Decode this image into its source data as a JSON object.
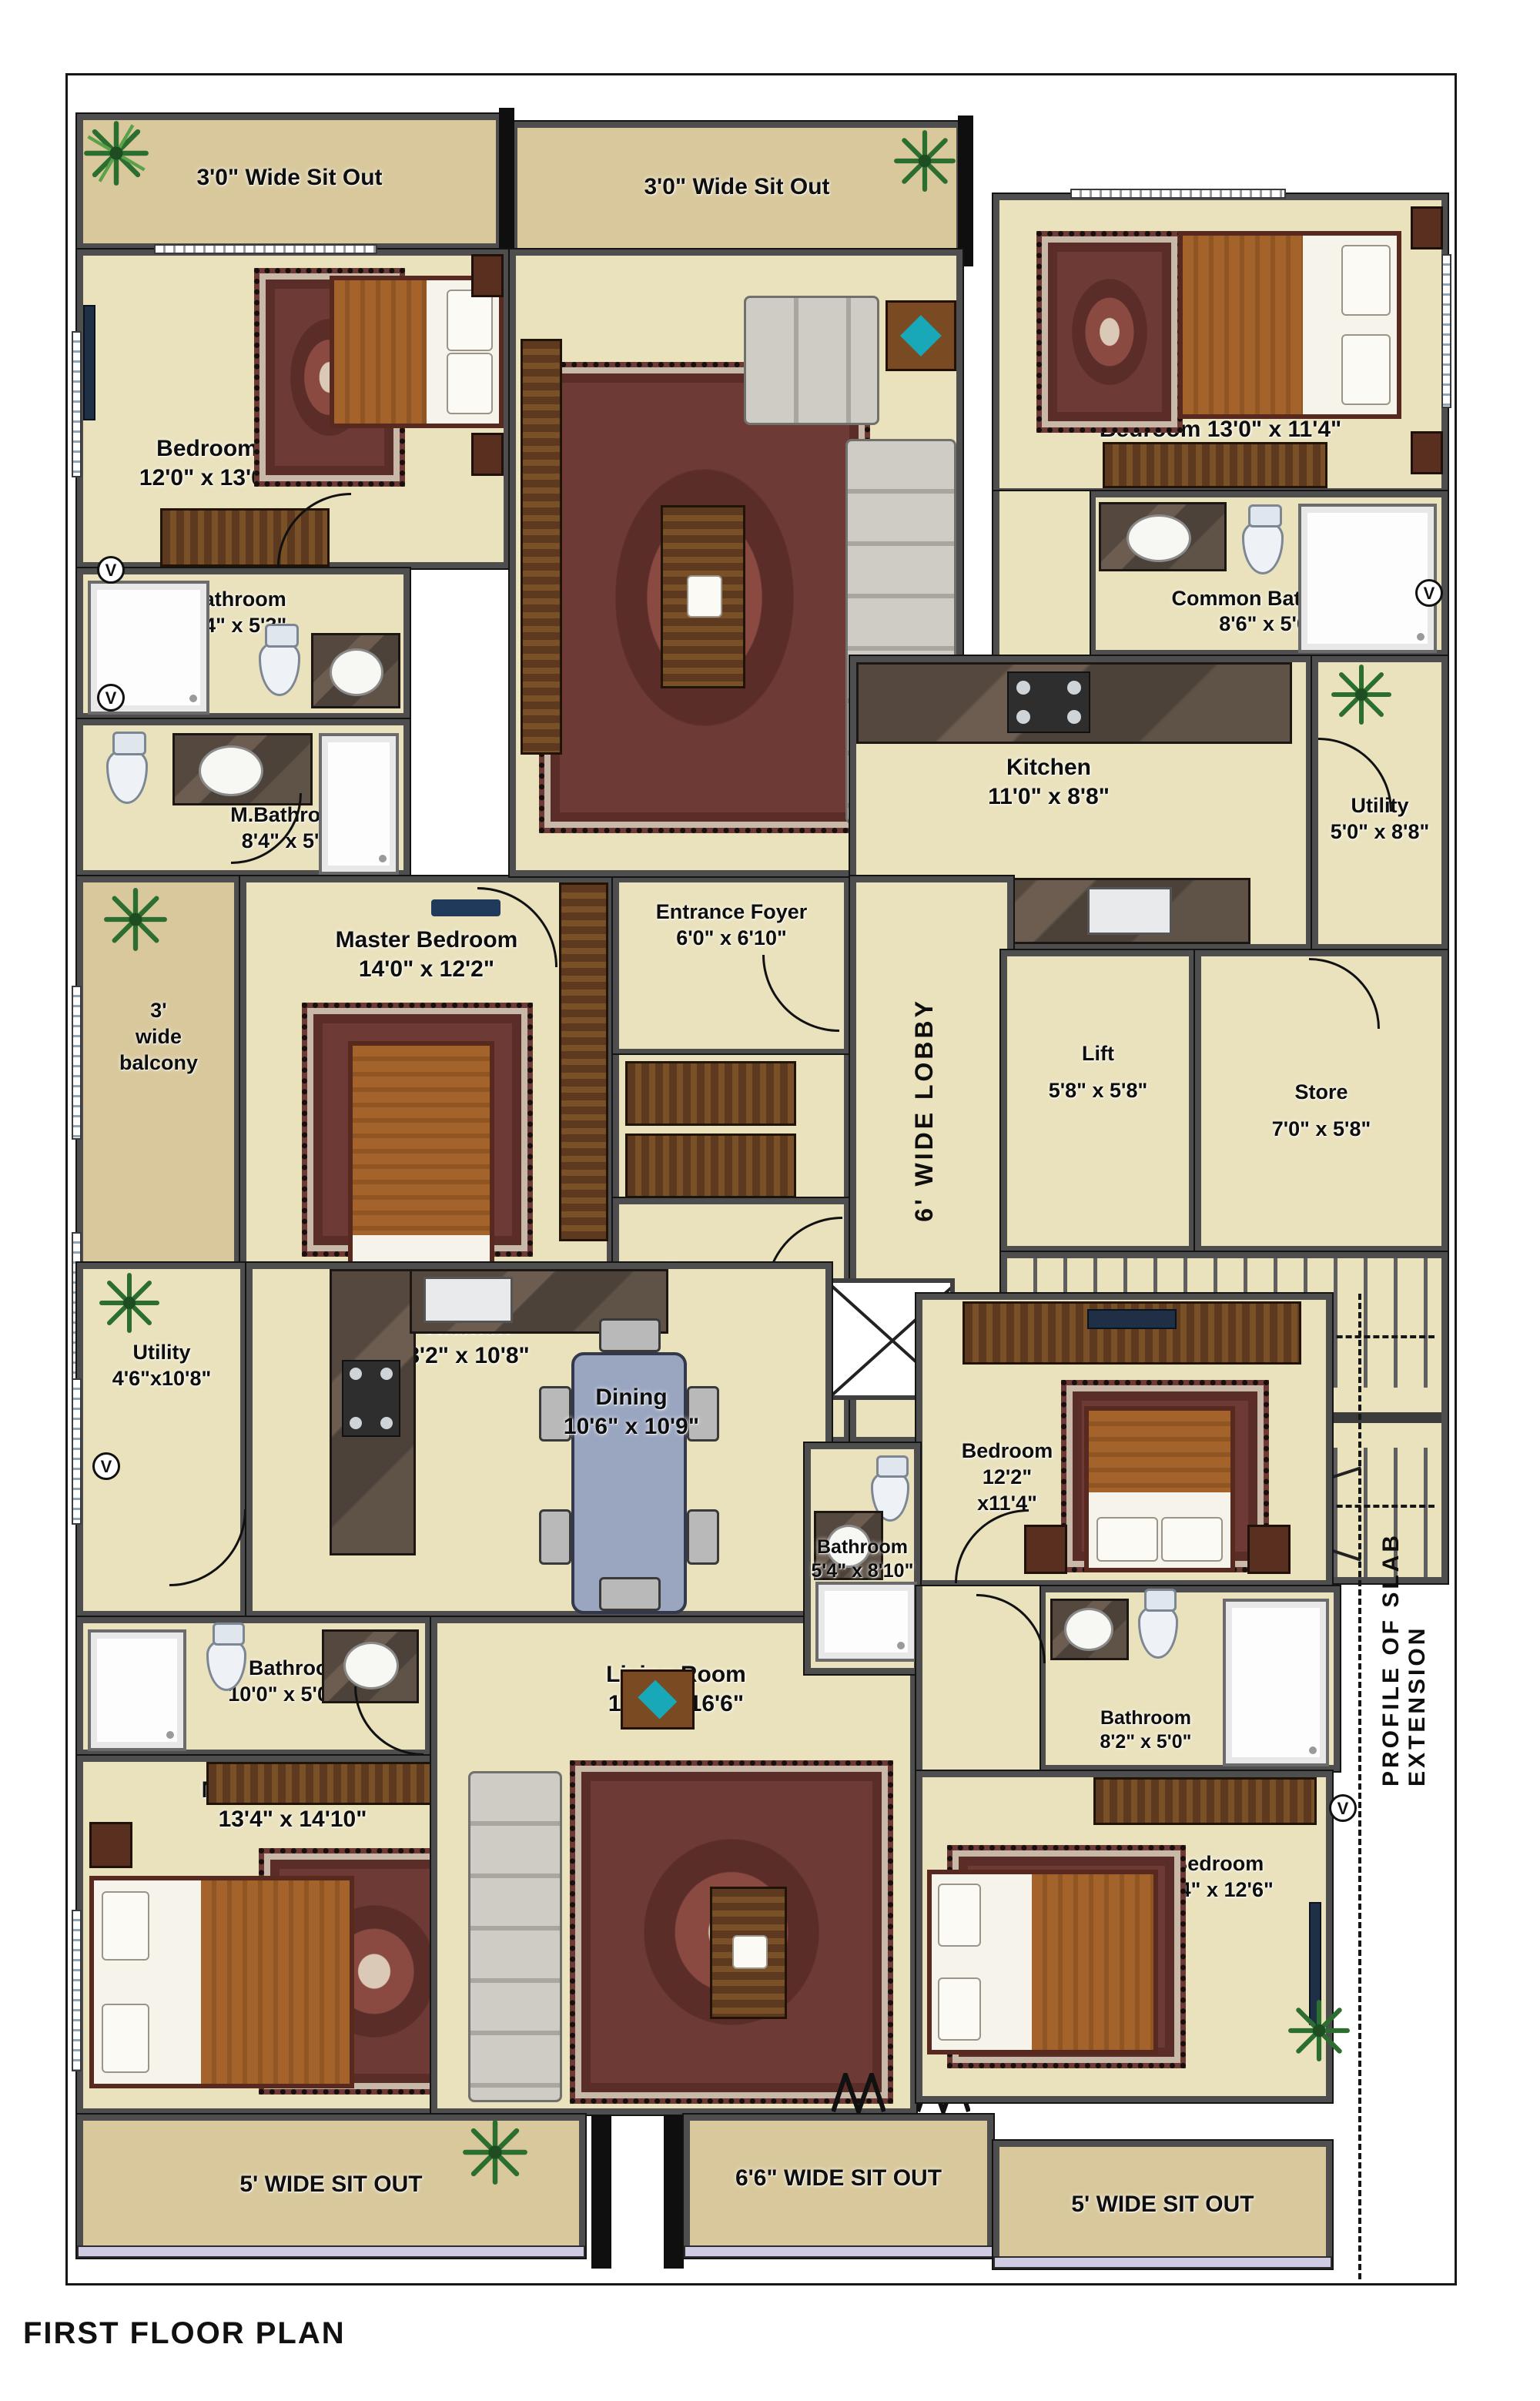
{
  "title": "FIRST FLOOR PLAN",
  "colors": {
    "floor": "#eae2bd",
    "sitout": "#d8c89c",
    "wall": "#4e4e4e",
    "rug": "#6e3a35",
    "wood": "#5d3a1f",
    "dining_table": "#9aa5c0"
  },
  "symbols": {
    "ventilator": "V"
  },
  "annotations": {
    "lobby": "6' WIDE LOBBY",
    "profile": "PROFILE OF SLAB EXTENSION"
  },
  "sitouts": {
    "top_left": "3'0\" Wide Sit Out",
    "top_mid": "3'0\" Wide Sit Out",
    "bottom_left": "5' WIDE SIT OUT",
    "bottom_mid": "6'6\" WIDE SIT OUT",
    "bottom_right": "5' WIDE SIT OUT"
  },
  "rooms": {
    "bedroom_a": {
      "name": "Bedroom",
      "dims": "12'0\" x 13'0\""
    },
    "living_a": {
      "name": "Living Room",
      "dims": "17'4\" x 15'2\""
    },
    "bedroom_b": {
      "name": "Bedroom  13'0\" x 11'4\""
    },
    "common_bath_b": {
      "name": "Common Bathroom",
      "dims": "8'6\" x 5'0\""
    },
    "bath_a": {
      "name": "Bathroom",
      "dims": "8'4\" x 5'3\""
    },
    "mbath_a": {
      "name": "M.Bathroom",
      "dims": "8'4\" x 5'3\""
    },
    "dining_a": {
      "name": "Dining Room",
      "dims": "17'4\" x 11'0\""
    },
    "kitchen_b": {
      "name": "Kitchen",
      "dims": "11'0\" x 8'8\""
    },
    "utility_b": {
      "name": "Utility",
      "dims": "5'0\" x 8'8\""
    },
    "master_a": {
      "name": "Master Bedroom",
      "dims": "14'0\" x 12'2\""
    },
    "balcony_a": {
      "l1": "3'",
      "l2": "wide",
      "l3": "balcony"
    },
    "foyer_a": {
      "name": "Entrance Foyer",
      "dims": "6'0\" x 6'10\""
    },
    "foyer_b": {
      "name": "Entrance",
      "name2": "Foyer",
      "dims": "6'0\" x 6'10\""
    },
    "lift": {
      "name": "Lift",
      "dims": "5'8\" x 5'8\""
    },
    "store": {
      "name": "Store",
      "dims": "7'0\" x 5'8\""
    },
    "utility_c": {
      "name": "Utility",
      "dims": "4'6\"x10'8\""
    },
    "kitchen_c": {
      "name": "Kitchen",
      "dims": "8'2\" x 10'8\""
    },
    "dining_c": {
      "name": "Dining",
      "dims": "10'6\" x 10'9\""
    },
    "mbath_c": {
      "name": "M. Bathroom",
      "dims": "10'0\" x 5'0\""
    },
    "living_c": {
      "name": "Living Room",
      "dims": "13'8\" x 16'6\""
    },
    "bath_d": {
      "name": "Bathroom",
      "dims": "5'4\" x 8'10\""
    },
    "bedroom_d": {
      "name": "Bedroom",
      "dims": "12'2\"",
      "dims2": "x11'4\""
    },
    "bath_d2": {
      "name": "Bathroom",
      "dims": "8'2\" x 5'0\""
    },
    "bedroom_d2": {
      "name": "Bedroom",
      "dims": "3'4\" x 12'6\""
    },
    "master_c": {
      "name": "Master Bedroom",
      "dims": "13'4\" x 14'10\""
    }
  }
}
